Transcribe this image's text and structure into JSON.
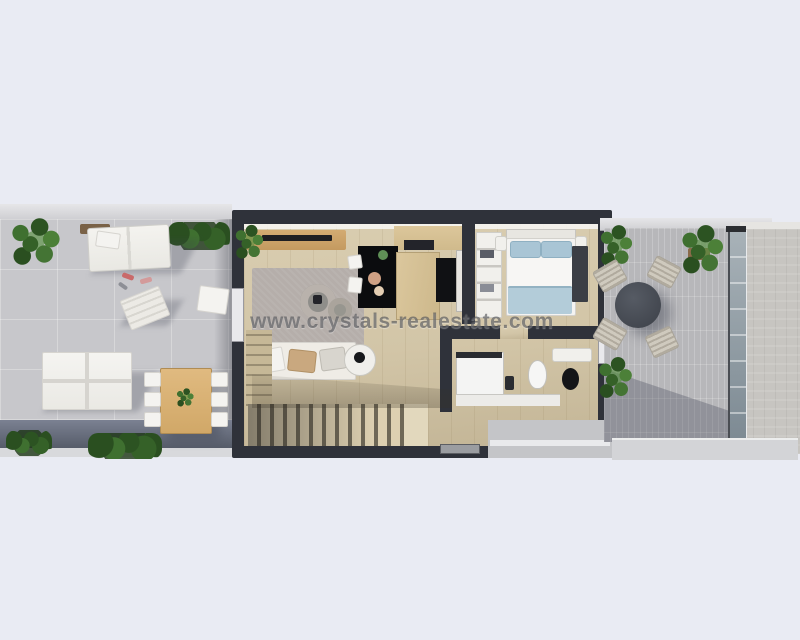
{
  "watermark": {
    "text": "www.crystals-realestate.com"
  },
  "colors": {
    "background": "#e9ebf3",
    "wall_dark": "#2f323a",
    "floor_wood": "#d2c5a7",
    "terrace_left_paving": "#c7c7cb",
    "terrace_right_paving": "#b7b7ba",
    "rug_gray": "#b5aeaa",
    "kitchen_counter_black": "#0b0c0e",
    "bed_blue": "#a9c5d5",
    "outdoor_table_wood": "#dcb67c",
    "plant_green": "#3f7030"
  }
}
